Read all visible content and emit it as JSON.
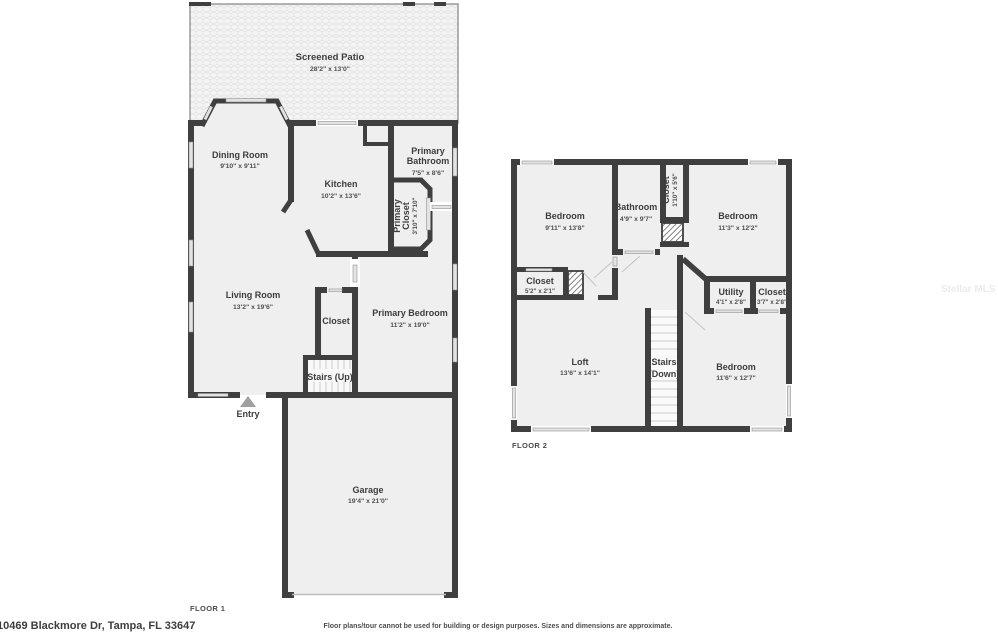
{
  "footer": {
    "address": "10469 Blackmore Dr, Tampa, FL 33647",
    "disclaimer": "Floor plans/tour cannot be used for building or design purposes. Sizes and dimensions are approximate."
  },
  "watermark": "Stellar MLS",
  "floor1": {
    "label": "FLOOR 1",
    "rooms": {
      "patio": {
        "name": "Screened Patio",
        "dims": "28'2\" x 13'0\""
      },
      "dining": {
        "name": "Dining Room",
        "dims": "9'10\" x 9'11\""
      },
      "kitchen": {
        "name": "Kitchen",
        "dims": "10'2\" x 13'6\""
      },
      "primary_bath": {
        "name1": "Primary",
        "name2": "Bathroom",
        "dims": "7'5\" x 8'6\""
      },
      "primary_closet": {
        "name1": "Primary",
        "name2": "Closet",
        "dims": "3'10\" x 7'10\""
      },
      "living": {
        "name": "Living Room",
        "dims": "13'2\" x 19'6\""
      },
      "closet": {
        "name": "Closet"
      },
      "primary_bedroom": {
        "name": "Primary Bedroom",
        "dims": "11'2\" x 19'0\""
      },
      "stairs": {
        "name": "Stairs (Up)"
      },
      "entry": {
        "name": "Entry"
      },
      "garage": {
        "name": "Garage",
        "dims": "19'4\" x 21'0\""
      }
    }
  },
  "floor2": {
    "label": "FLOOR 2",
    "rooms": {
      "bedroom_tl": {
        "name": "Bedroom",
        "dims": "9'11\" x 13'8\""
      },
      "bathroom": {
        "name": "Bathroom",
        "dims": "4'9\" x 9'7\""
      },
      "closet_small": {
        "name": "Closet",
        "dims": "1'10\" x 5'6\""
      },
      "bedroom_tr": {
        "name": "Bedroom",
        "dims": "11'3\" x 12'2\""
      },
      "closet_left": {
        "name": "Closet",
        "dims": "5'2\" x 2'1\""
      },
      "utility": {
        "name": "Utility",
        "dims": "4'1\" x 2'8\""
      },
      "closet_right": {
        "name": "Closet",
        "dims": "3'7\" x 2'8\""
      },
      "loft": {
        "name": "Loft",
        "dims": "13'6\" x 14'1\""
      },
      "stairs": {
        "name1": "Stairs",
        "name2": "(Down)"
      },
      "bedroom_b": {
        "name": "Bedroom",
        "dims": "11'6\" x 12'7\""
      }
    }
  }
}
